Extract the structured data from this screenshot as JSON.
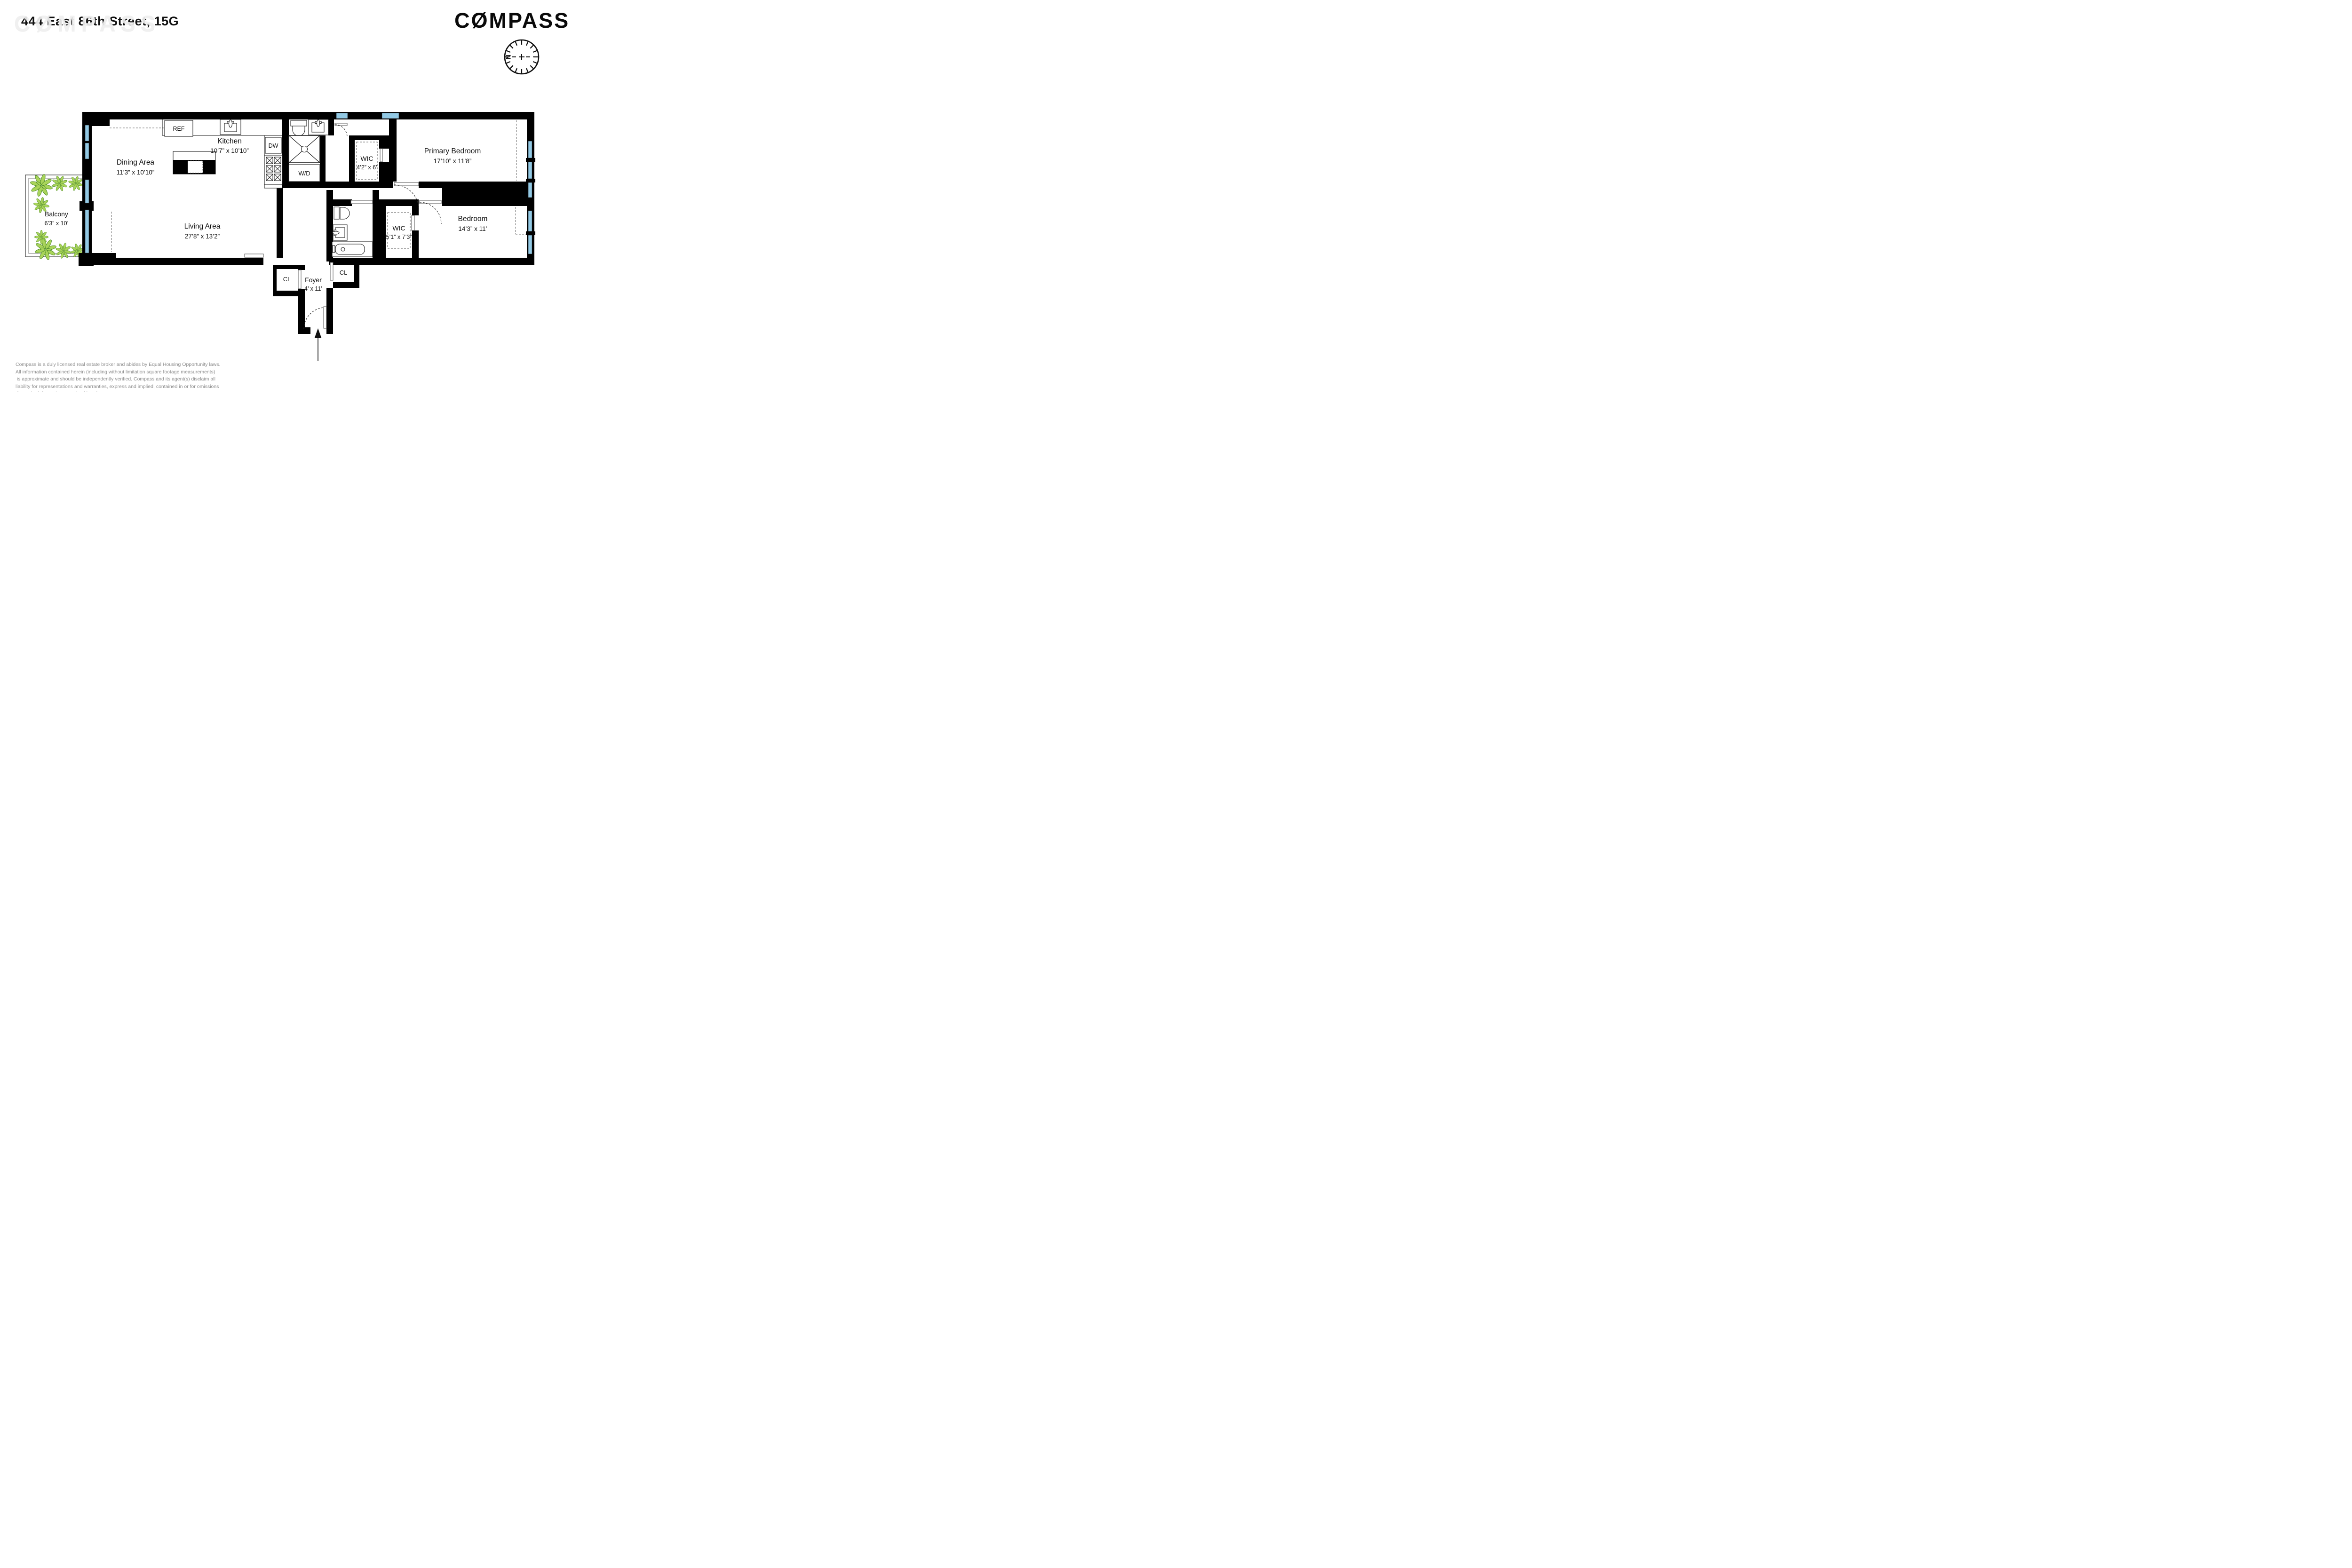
{
  "header": {
    "title": "444 East 86th Street, 15G",
    "watermark_display": "CØMPASS",
    "brand": {
      "name": "COMPASS",
      "logo_display": "CØMPASS"
    },
    "compass_rose_label": "N"
  },
  "rooms": {
    "dining": {
      "name": "Dining Area",
      "dims": "11’3” x 10’10”"
    },
    "kitchen": {
      "name": "Kitchen",
      "dims": "10’7” x 10’10”"
    },
    "living": {
      "name": "Living Area",
      "dims": "27’8” x 13’2”"
    },
    "balcony": {
      "name": "Balcony",
      "dims": "6’3” x 10’"
    },
    "primary": {
      "name": "Primary Bedroom",
      "dims": "17’10” x 11’8”"
    },
    "bedroom": {
      "name": "Bedroom",
      "dims": "14’3” x 11’"
    },
    "wic_primary": {
      "name": "WIC",
      "dims": "4’2” x 6’"
    },
    "wic_bedroom": {
      "name": "WIC",
      "dims": "5’1” x 7’3”"
    },
    "foyer": {
      "name": "Foyer",
      "dims": "4’ x 11’"
    }
  },
  "fixtures": {
    "refrigerator": "REF",
    "dishwasher": "DW",
    "washer_dryer": "W/D",
    "closet": "CL"
  },
  "disclaimer": {
    "lines": [
      "Compass is a duly licensed real estate broker and abides by Equal Housing Opportunity laws.",
      "All information contained herein (including without limitation square footage measurements)",
      " is approximate and should be independently verified. Compass and its agent(s) disclaim all",
      "liability for representations and warranties, express and implied, contained in or for omissions",
      " from, the information contained herein"
    ]
  },
  "colors": {
    "wall": "#000000",
    "window_glass": "#92c9e4",
    "plant_fill": "#a9d45a",
    "plant_stroke": "#4c8a28",
    "watermark": "#f0f0f0",
    "disclaimer_text": "#8f8f8f"
  }
}
